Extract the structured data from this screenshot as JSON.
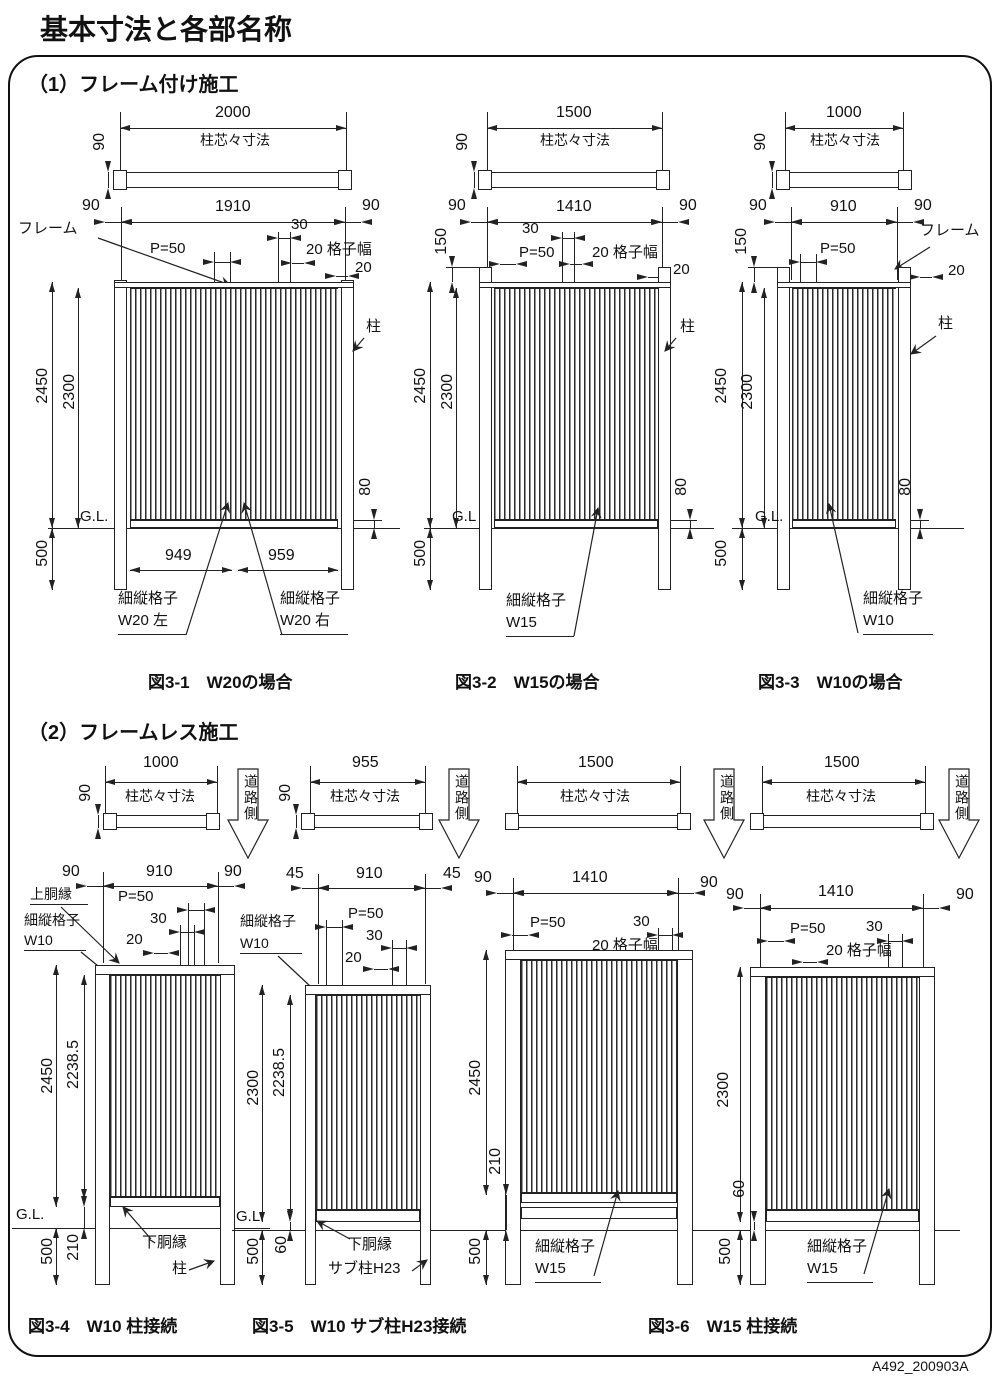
{
  "page": {
    "title": "基本寸法と各部名称",
    "code": "A492_200903A"
  },
  "sections": {
    "s1": "（1）フレーム付け施工",
    "s2": "（2）フレームレス施工"
  },
  "common": {
    "post_center": "柱芯々寸法",
    "road": "道路側",
    "frame": "フレーム",
    "post": "柱",
    "upper_rail": "上胴縁",
    "lower_rail": "下胴縁",
    "sub_post": "サブ柱H23",
    "lattice": "細縦格子",
    "gl": "G.L.",
    "gl2": "G.L",
    "p50": "P=50",
    "n45": "45",
    "n60": "60",
    "n80": "80",
    "n90": "90",
    "n150": "150",
    "n210": "210",
    "n500": "500",
    "n910": "910",
    "n1000": "1000",
    "n1410": "1410",
    "n1500": "1500",
    "n2300": "2300",
    "n2450": "2450",
    "n22385": "2238.5",
    "n30": "30",
    "n20": "20",
    "n20w": "20 格子幅"
  },
  "fig31": {
    "span": "2000",
    "clear": "1910",
    "wl": "949",
    "wr": "959",
    "latL": "W20 左",
    "latR": "W20 右",
    "cap": "図3-1　W20の場合"
  },
  "fig32": {
    "lat": "W15",
    "cap": "図3-2　W15の場合"
  },
  "fig33": {
    "lat": "W10",
    "cap": "図3-3　W10の場合"
  },
  "fig34": {
    "lat": "W10",
    "cap": "図3-4　W10 柱接続"
  },
  "fig35": {
    "span": "955",
    "lat": "W10",
    "cap": "図3-5　W10 サブ柱H23接続"
  },
  "fig36": {
    "lat": "W15",
    "cap": "図3-6　W15 柱接続"
  }
}
